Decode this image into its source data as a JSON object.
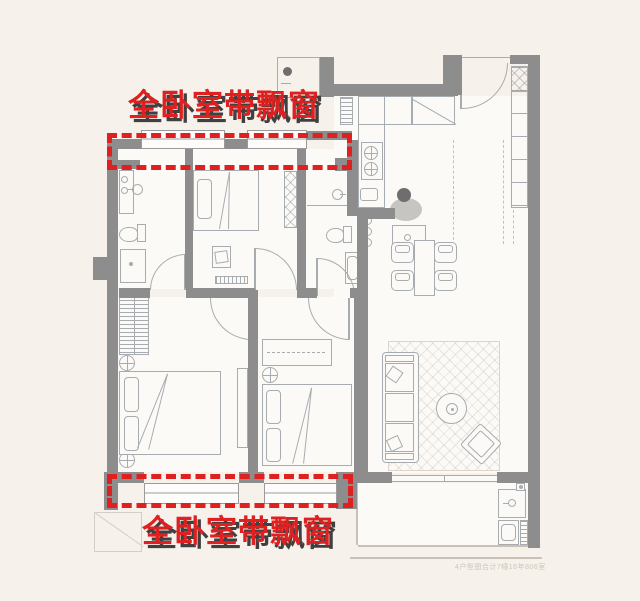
{
  "annotations": {
    "top": "全卧室带飘窗",
    "bottom": "全卧室带飘窗"
  },
  "watermark": "4户型图合计7幢16年806室",
  "colors": {
    "background": "#f6f1ea",
    "floor": "#fcfaf7",
    "wall": "#8d8d8d",
    "line": "#a7acb0",
    "line_soft": "#c9c1b8",
    "highlight_red": "#df2020",
    "label_shadow": "#404040",
    "watermark": "#cfc5ba"
  },
  "icons": [
    "bay-window",
    "double-bed",
    "single-bed",
    "pillow",
    "wardrobe",
    "dresser",
    "nightstand",
    "toilet",
    "shower",
    "washbasin",
    "faucet",
    "gas-stove",
    "kitchen-sink",
    "refrigerator",
    "water-heater",
    "dining-table",
    "dining-chair",
    "bar-stool",
    "person",
    "sofa",
    "coffee-table",
    "armchair",
    "rug",
    "entry-closet",
    "door-arc",
    "sliding-door",
    "laundry-sink",
    "washing-machine",
    "floor-drain",
    "ac-platform",
    "radiator",
    "tv-stand",
    "duct"
  ]
}
